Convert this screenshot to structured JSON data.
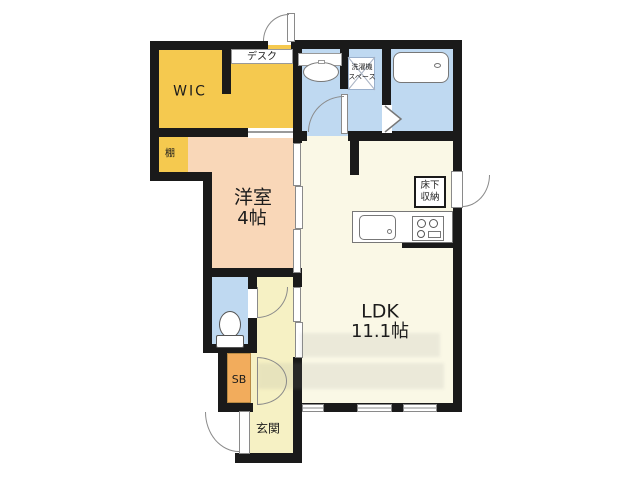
{
  "colors": {
    "wall": "#1a1a1a",
    "wic-yellow": "#f5c94f",
    "room-peach": "#f9d7b8",
    "wet-blue": "#bfd9f1",
    "ldk-cream": "#faf8e6",
    "hall-yellow": "#f6f1c4",
    "sb-orange": "#f2ac5c"
  },
  "labels": {
    "wic": "WIC",
    "desk": "デスク",
    "shelf": "棚",
    "western_room": {
      "name": "洋室",
      "size": "4帖"
    },
    "ldk": {
      "name": "LDK",
      "size": "11.1帖"
    },
    "laundry": {
      "line1": "洗濯機",
      "line2": "スペース"
    },
    "underfloor": {
      "line1": "床下",
      "line2": "収納"
    },
    "shoe_box": "SB",
    "entrance": "玄関"
  }
}
